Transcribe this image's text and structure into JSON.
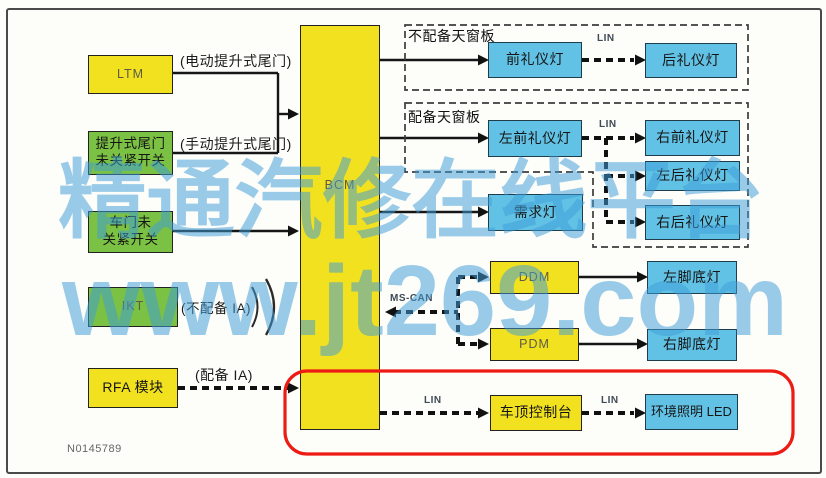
{
  "figure_number": "N0145789",
  "watermark": {
    "line1": "精通汽修在线平台",
    "line2": "www.jt269.com",
    "color": "#3f9ed8"
  },
  "bus": {
    "lin": "LIN",
    "mscan": "MS-CAN"
  },
  "groups": {
    "no_sunroof": "不配备天窗板",
    "sunroof": "配备天窗板"
  },
  "annotations": {
    "power_liftgate": "(电动提升式尾门)",
    "manual_liftgate": "(手动提升式尾门)",
    "without_ia": "(不配备 IA)",
    "with_ia": "(配备 IA)"
  },
  "nodes": {
    "ltm": "LTM",
    "liftgate_switch_line1": "提升式尾门",
    "liftgate_switch_line2": "未关紧开关",
    "door_switch_line1": "车门未",
    "door_switch_line2": "关紧开关",
    "ikt": "IKT",
    "rfa": "RFA 模块",
    "bcm": "BCM",
    "front_courtesy": "前礼仪灯",
    "rear_courtesy": "后礼仪灯",
    "lf_courtesy": "左前礼仪灯",
    "rf_courtesy": "右前礼仪灯",
    "lr_courtesy": "左后礼仪灯",
    "rr_courtesy": "右后礼仪灯",
    "demand_lamp": "需求灯",
    "ddm": "DDM",
    "pdm": "PDM",
    "left_footwell": "左脚底灯",
    "right_footwell": "右脚底灯",
    "roof_console": "车顶控制台",
    "ambient_led": "环境照明 LED"
  },
  "colors": {
    "module_yellow": "#f2e11e",
    "switch_green": "#7bc143",
    "lamp_blue": "#62c2e5",
    "highlight_red": "#ee1a14"
  }
}
